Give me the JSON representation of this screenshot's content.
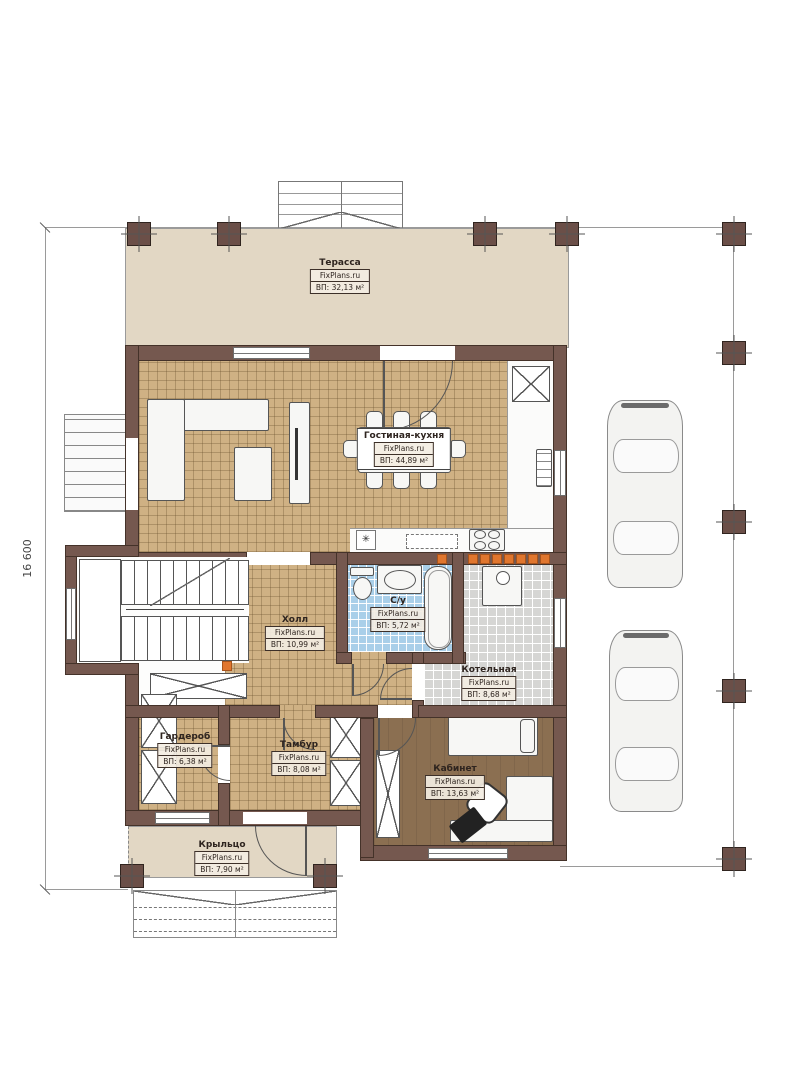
{
  "plan": {
    "brand": "FixPlans.ru",
    "dimension_left": "16 600",
    "rooms": [
      {
        "id": "terrace",
        "name": "Терасса",
        "brand": "FixPlans.ru",
        "area": "ВП: 32,13 м²"
      },
      {
        "id": "living-kitchen",
        "name": "Гостиная-кухня",
        "brand": "FixPlans.ru",
        "area": "ВП: 44,89 м²"
      },
      {
        "id": "hall",
        "name": "Холл",
        "brand": "FixPlans.ru",
        "area": "ВП: 10,99 м²"
      },
      {
        "id": "bathroom",
        "name": "С/у",
        "brand": "FixPlans.ru",
        "area": "ВП: 5,72 м²"
      },
      {
        "id": "boiler",
        "name": "Котельная",
        "brand": "FixPlans.ru",
        "area": "ВП: 8,68 м²"
      },
      {
        "id": "wardrobe",
        "name": "Гардероб",
        "brand": "FixPlans.ru",
        "area": "ВП: 6,38 м²"
      },
      {
        "id": "tambour",
        "name": "Тамбур",
        "brand": "FixPlans.ru",
        "area": "ВП: 8,08 м²"
      },
      {
        "id": "office",
        "name": "Кабинет",
        "brand": "FixPlans.ru",
        "area": "ВП: 13,63 м²"
      },
      {
        "id": "porch",
        "name": "Крыльцо",
        "brand": "FixPlans.ru",
        "area": "ВП: 7,90 м²"
      }
    ],
    "symbols": {
      "sink": "✳"
    },
    "colors": {
      "wall": "#75584f",
      "floor_tile": "#cfb184",
      "bath_tile": "#a9cfe9",
      "boiler_tile": "#d6d6d4",
      "wood": "#8b6f51",
      "terrace": "#e2d7c4",
      "spot": "#e0762e"
    }
  }
}
